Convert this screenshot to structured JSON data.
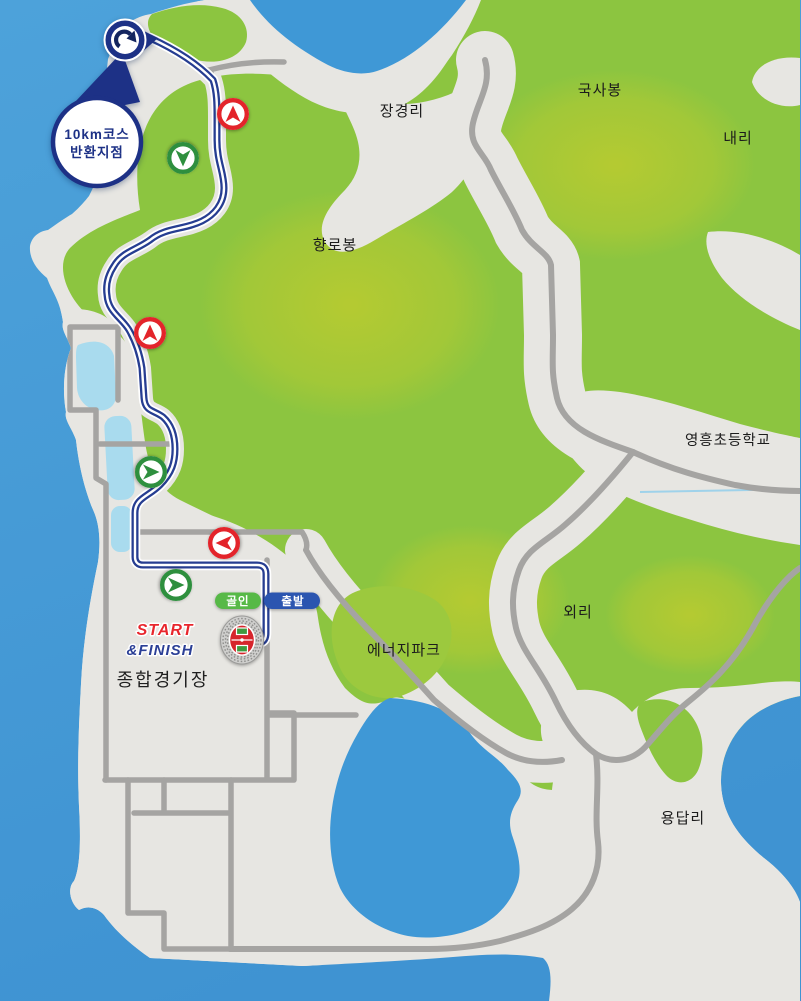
{
  "map": {
    "title_semantic": "10km race course map with turnaround point and stadium start/finish",
    "places": {
      "janggyeongri": "장경리",
      "guksabong": "국사봉",
      "naeri": "내리",
      "hyangrobong": "향로봉",
      "school": "영흥초등학교",
      "oeri": "외리",
      "energypark": "에너지파크",
      "yongdapri": "용답리",
      "stadium_name": "종합경기장"
    },
    "callout": {
      "line1": "10km코스",
      "line2": "반환지점"
    },
    "stadium": {
      "start_label": "START",
      "finish_label": "&FINISH"
    },
    "pills": {
      "finish": "골인",
      "start": "출발"
    },
    "markers": [
      {
        "id": "turnaround-point",
        "kind": "u-turn-icon",
        "color": "#1d3186"
      },
      {
        "id": "course-arrow-1",
        "direction": "up",
        "color": "#e3242b"
      },
      {
        "id": "course-arrow-2",
        "direction": "down",
        "color": "#2e8f3e"
      },
      {
        "id": "course-arrow-3",
        "direction": "up",
        "color": "#e3242b"
      },
      {
        "id": "course-arrow-4",
        "direction": "right",
        "color": "#2e8f3e"
      },
      {
        "id": "course-arrow-5",
        "direction": "left",
        "color": "#e3242b"
      },
      {
        "id": "course-arrow-6",
        "direction": "right",
        "color": "#2e8f3e"
      }
    ],
    "colors": {
      "water": "#3f98d6",
      "water_light": "#55a5dc",
      "land": "#e7e6e2",
      "green": "#8cc540",
      "green_light": "#bccb2f",
      "road": "#a5a4a2",
      "route_navy": "#263d91",
      "marker_red": "#e3242b",
      "marker_green": "#2e8f3e",
      "pill_green": "#57b947",
      "pill_blue": "#2b55b0",
      "pin_navy": "#1d3186",
      "pond": "#a9dbee",
      "start_red": "#e8262d",
      "finish_blue": "#2b3f96"
    }
  }
}
